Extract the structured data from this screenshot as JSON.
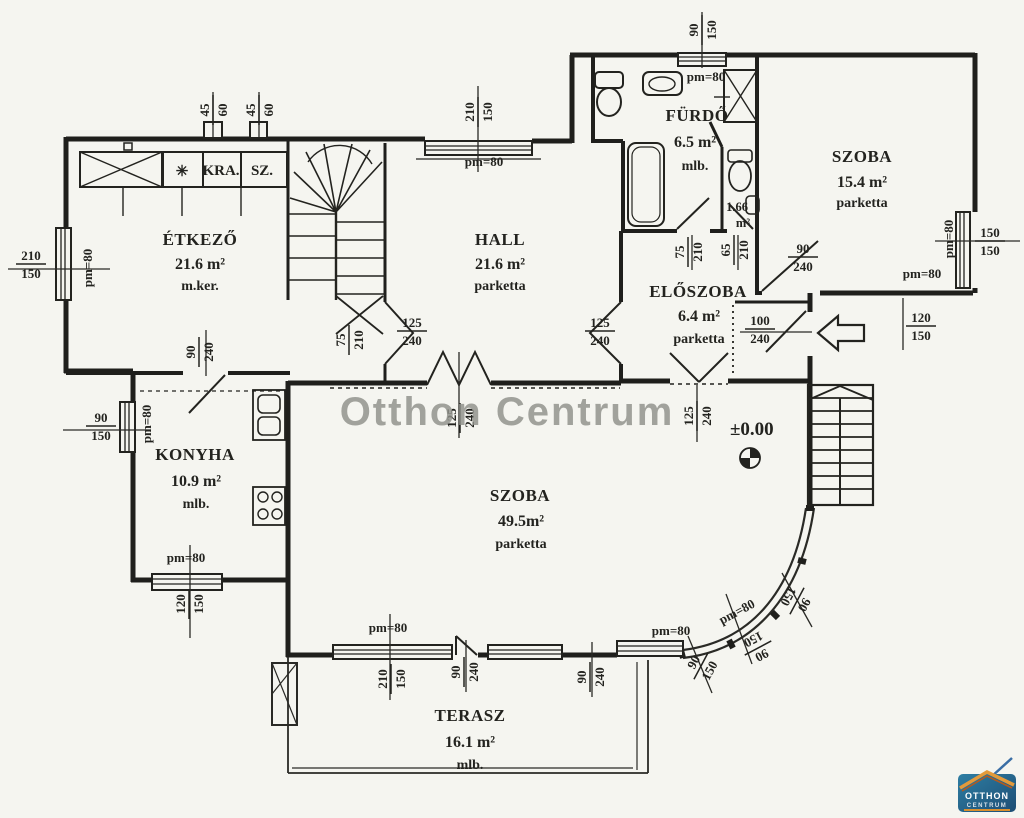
{
  "watermark": {
    "text": "Otthon Centrum"
  },
  "level_marker": {
    "label": "±0.00"
  },
  "closets": {
    "kra": "KRA.",
    "sz": "SZ.",
    "asterisk": "✳"
  },
  "wc_area": {
    "line1": "1.66",
    "line2": "m²"
  },
  "logo": {
    "line1": "OTTHON",
    "line2": "CENTRUM"
  },
  "colors": {
    "ink": "#23231f",
    "paper": "#f5f5f0",
    "watermark": "#8f908a",
    "logo_blue": "#1d4d74",
    "logo_teal": "#2e7ea3",
    "logo_orange": "#e39a3b"
  },
  "rooms": [
    {
      "id": "etkezo",
      "name": "ÉTKEZŐ",
      "area": "21.6 m²",
      "floor": "m.ker."
    },
    {
      "id": "hall",
      "name": "HALL",
      "area": "21.6 m²",
      "floor": "parketta"
    },
    {
      "id": "furdo",
      "name": "FÜRDŐ",
      "area": "6.5 m²",
      "floor": "mlb."
    },
    {
      "id": "szoba1",
      "name": "SZOBA",
      "area": "15.4 m²",
      "floor": "parketta"
    },
    {
      "id": "eloszoba",
      "name": "ELŐSZOBA",
      "area": "6.4 m²",
      "floor": "parketta"
    },
    {
      "id": "konyha",
      "name": "KONYHA",
      "area": "10.9 m²",
      "floor": "mlb."
    },
    {
      "id": "szoba2",
      "name": "SZOBA",
      "area": "49.5m²",
      "floor": "parketta"
    },
    {
      "id": "terasz",
      "name": "TERASZ",
      "area": "16.1 m²",
      "floor": "mlb."
    }
  ],
  "room_pos": {
    "etkezo": {
      "x": 200,
      "y": 240
    },
    "hall": {
      "x": 500,
      "y": 240
    },
    "furdo": {
      "x": 697,
      "y": 116
    },
    "szoba1": {
      "x": 862,
      "y": 157
    },
    "eloszoba": {
      "x": 698,
      "y": 292
    },
    "konyha": {
      "x": 195,
      "y": 455
    },
    "szoba2": {
      "x": 520,
      "y": 496
    },
    "terasz": {
      "x": 470,
      "y": 716
    }
  },
  "dimensions": [
    {
      "x": 213,
      "y": 110,
      "rot": -90,
      "num": "45",
      "den": "60"
    },
    {
      "x": 259,
      "y": 110,
      "rot": -90,
      "num": "45",
      "den": "60"
    },
    {
      "x": 478,
      "y": 112,
      "rot": -90,
      "num": "210",
      "den": "150"
    },
    {
      "x": 484,
      "y": 162,
      "rot": 0,
      "text": "pm=80"
    },
    {
      "x": 702,
      "y": 30,
      "rot": -90,
      "num": "90",
      "den": "150"
    },
    {
      "x": 706,
      "y": 77,
      "rot": 0,
      "text": "pm=80"
    },
    {
      "x": 31,
      "y": 264,
      "rot": 0,
      "num": "210",
      "den": "150"
    },
    {
      "x": 88,
      "y": 268,
      "rot": -90,
      "text": "pm=80"
    },
    {
      "x": 101,
      "y": 426,
      "rot": 0,
      "num": "90",
      "den": "150"
    },
    {
      "x": 147,
      "y": 424,
      "rot": -90,
      "text": "pm=80"
    },
    {
      "x": 199,
      "y": 352,
      "rot": -90,
      "num": "90",
      "den": "240"
    },
    {
      "x": 349,
      "y": 340,
      "rot": -90,
      "num": "75",
      "den": "210"
    },
    {
      "x": 412,
      "y": 331,
      "rot": 0,
      "num": "125",
      "den": "240"
    },
    {
      "x": 600,
      "y": 331,
      "rot": 0,
      "num": "125",
      "den": "240"
    },
    {
      "x": 688,
      "y": 252,
      "rot": -90,
      "num": "75",
      "den": "210"
    },
    {
      "x": 734,
      "y": 250,
      "rot": -90,
      "num": "65",
      "den": "210"
    },
    {
      "x": 803,
      "y": 257,
      "rot": 0,
      "num": "90",
      "den": "240"
    },
    {
      "x": 760,
      "y": 329,
      "rot": 0,
      "num": "100",
      "den": "240"
    },
    {
      "x": 697,
      "y": 416,
      "rot": -90,
      "num": "125",
      "den": "240"
    },
    {
      "x": 460,
      "y": 418,
      "rot": -90,
      "num": "125",
      "den": "240"
    },
    {
      "x": 990,
      "y": 241,
      "rot": 0,
      "num": "150",
      "den": "150"
    },
    {
      "x": 949,
      "y": 239,
      "rot": -90,
      "text": "pm=80"
    },
    {
      "x": 922,
      "y": 274,
      "rot": 0,
      "text": "pm=80"
    },
    {
      "x": 921,
      "y": 326,
      "rot": 0,
      "num": "120",
      "den": "150"
    },
    {
      "x": 186,
      "y": 558,
      "rot": 0,
      "text": "pm=80"
    },
    {
      "x": 189,
      "y": 604,
      "rot": -90,
      "num": "120",
      "den": "150"
    },
    {
      "x": 388,
      "y": 628,
      "rot": 0,
      "text": "pm=80"
    },
    {
      "x": 391,
      "y": 679,
      "rot": -90,
      "num": "210",
      "den": "150"
    },
    {
      "x": 464,
      "y": 672,
      "rot": -90,
      "num": "90",
      "den": "240"
    },
    {
      "x": 590,
      "y": 677,
      "rot": -90,
      "num": "90",
      "den": "240"
    },
    {
      "x": 671,
      "y": 631,
      "rot": 0,
      "text": "pm=80"
    },
    {
      "x": 701,
      "y": 666,
      "rot": -62,
      "num": "90",
      "den": "150"
    },
    {
      "x": 737,
      "y": 612,
      "rot": -28,
      "text": "pm=80"
    },
    {
      "x": 758,
      "y": 648,
      "rot": 152,
      "num": "90",
      "den": "150"
    },
    {
      "x": 797,
      "y": 601,
      "rot": 118,
      "num": "90",
      "den": "150"
    }
  ]
}
